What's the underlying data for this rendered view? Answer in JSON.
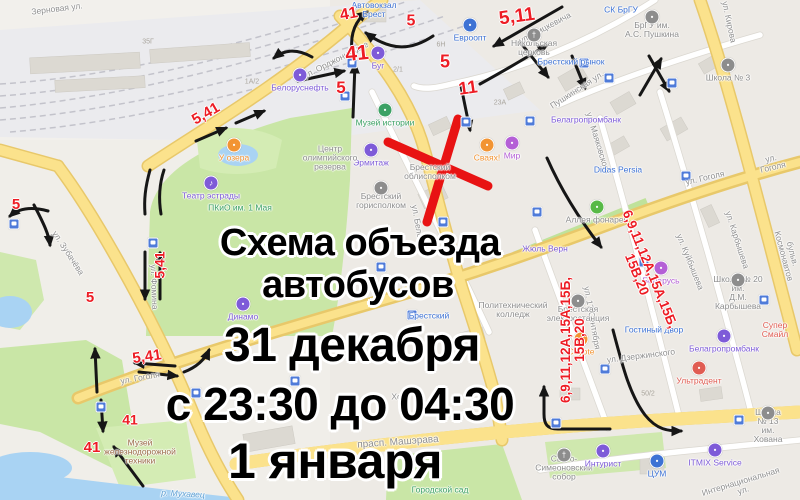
{
  "page": {
    "width": 800,
    "height": 500
  },
  "overlay": {
    "lines": [
      {
        "text": "Схема объезда",
        "x": 360,
        "y": 222,
        "size": 38
      },
      {
        "text": "автобусов",
        "x": 358,
        "y": 264,
        "size": 38
      },
      {
        "text": "31 декабря",
        "x": 352,
        "y": 318,
        "size": 48
      },
      {
        "text": "с 23:30 до 04:30",
        "x": 340,
        "y": 377,
        "size": 46
      },
      {
        "text": "1 января",
        "x": 335,
        "y": 432,
        "size": 50
      }
    ]
  },
  "route_labels": [
    {
      "text": "41",
      "x": 349,
      "y": 15,
      "size": 16,
      "rot": -10
    },
    {
      "text": "5",
      "x": 411,
      "y": 22,
      "size": 16,
      "rot": 0
    },
    {
      "text": "5,11",
      "x": 517,
      "y": 17,
      "size": 19,
      "rot": -8
    },
    {
      "text": "41",
      "x": 357,
      "y": 54,
      "size": 21,
      "rot": -6
    },
    {
      "text": "5",
      "x": 445,
      "y": 62,
      "size": 18,
      "rot": 0
    },
    {
      "text": "11",
      "x": 468,
      "y": 88,
      "size": 18,
      "rot": -8
    },
    {
      "text": "5",
      "x": 341,
      "y": 88,
      "size": 17,
      "rot": 0
    },
    {
      "text": "5,41",
      "x": 206,
      "y": 114,
      "size": 15,
      "rot": -30
    },
    {
      "text": "5",
      "x": 16,
      "y": 205,
      "size": 15,
      "rot": 0
    },
    {
      "text": "5",
      "x": 90,
      "y": 298,
      "size": 15,
      "rot": 0
    },
    {
      "text": "5,41",
      "x": 160,
      "y": 265,
      "size": 14,
      "rot": -90
    },
    {
      "text": "5,41",
      "x": 147,
      "y": 357,
      "size": 15,
      "rot": -8
    },
    {
      "text": "41",
      "x": 130,
      "y": 420,
      "size": 14,
      "rot": 0
    },
    {
      "text": "41",
      "x": 92,
      "y": 448,
      "size": 15,
      "rot": 0
    }
  ],
  "multi_route_labels": [
    {
      "text": "6,9,11,12А,15А,15Б,\n15В,20",
      "x": 643,
      "y": 272,
      "size": 13.5,
      "rot": 68
    },
    {
      "text": "6,9,11,12А,15А,15Б,\n15В,20",
      "x": 573,
      "y": 340,
      "size": 13.5,
      "rot": -90
    }
  ],
  "streets": [
    {
      "text": "Зерновая ул.",
      "x": 57,
      "y": 9,
      "rot": -7
    },
    {
      "text": "ул. Орджоникидзе",
      "x": 336,
      "y": 60,
      "rot": -27
    },
    {
      "text": "ул. Мицкевича",
      "x": 545,
      "y": 28,
      "rot": -28
    },
    {
      "text": "ул. Кирова",
      "x": 729,
      "y": 22,
      "rot": 78
    },
    {
      "text": "Пушкинская ул.",
      "x": 577,
      "y": 90,
      "rot": -33
    },
    {
      "text": "ул. Маяковского",
      "x": 598,
      "y": 143,
      "rot": 73
    },
    {
      "text": "ул. Куйбышева",
      "x": 690,
      "y": 262,
      "rot": 68
    },
    {
      "text": "ул. Карбышева",
      "x": 737,
      "y": 240,
      "rot": 72
    },
    {
      "text": "ул. Гоголя",
      "x": 705,
      "y": 178,
      "rot": -13
    },
    {
      "text": "ул. Гоголя",
      "x": 772,
      "y": 163,
      "rot": -13
    },
    {
      "text": "бульв. Космонавтов",
      "x": 788,
      "y": 255,
      "rot": 75
    },
    {
      "text": "ул. Зубачёва",
      "x": 68,
      "y": 253,
      "rot": 57
    },
    {
      "text": "ул. Фомина",
      "x": 154,
      "y": 287,
      "rot": 88
    },
    {
      "text": "ул. Гоголя",
      "x": 140,
      "y": 378,
      "rot": -10
    },
    {
      "text": "прасп. Машэрава",
      "x": 398,
      "y": 443,
      "rot": -4,
      "size": 10
    },
    {
      "text": "ул. Дзержинского",
      "x": 641,
      "y": 356,
      "rot": -7
    },
    {
      "text": "Интернациональная ул.",
      "x": 742,
      "y": 486,
      "rot": -17
    },
    {
      "text": "ул. 17 Сентября",
      "x": 592,
      "y": 318,
      "rot": 80
    },
    {
      "text": "ул. Белова",
      "x": 418,
      "y": 226,
      "rot": 80
    },
    {
      "text": "р. Мухавец",
      "x": 183,
      "y": 494,
      "rot": 3,
      "color": "#5d9fd3",
      "italic": true
    }
  ],
  "pois": [
    {
      "text": "Автовокзал\nБрест",
      "x": 374,
      "y": 10,
      "color": "blue"
    },
    {
      "text": "Белоруснефть",
      "x": 300,
      "y": 88,
      "color": "purple",
      "icon": true
    },
    {
      "text": "Буг",
      "x": 378,
      "y": 66,
      "color": "purple",
      "icon": true
    },
    {
      "text": "Евроопт",
      "x": 470,
      "y": 38,
      "color": "blue",
      "icon": true
    },
    {
      "text": "Никольская\nцерковь",
      "x": 534,
      "y": 48,
      "color": "gray",
      "icon": true,
      "glyph": "†"
    },
    {
      "text": "СК БрГУ",
      "x": 621,
      "y": 10,
      "color": "blue"
    },
    {
      "text": "БрГУ им.\nА.С. Пушкина",
      "x": 652,
      "y": 30,
      "color": "gray",
      "icon": true
    },
    {
      "text": "Брестский рынок",
      "x": 571,
      "y": 62,
      "color": "blue"
    },
    {
      "text": "Белагропромбанк",
      "x": 586,
      "y": 120,
      "color": "purple"
    },
    {
      "text": "Школа № 3",
      "x": 728,
      "y": 78,
      "color": "gray",
      "icon": true
    },
    {
      "text": "Школа № 20 им.\nД.М. Карбышева",
      "x": 738,
      "y": 293,
      "color": "gray",
      "icon": true
    },
    {
      "text": "Школа № 13\nим. Хована",
      "x": 768,
      "y": 426,
      "color": "gray",
      "icon": true
    },
    {
      "text": "Didas Persia",
      "x": 618,
      "y": 170,
      "color": "blue"
    },
    {
      "text": "Аллея фонарей",
      "x": 597,
      "y": 220,
      "color": "gray",
      "icon": true,
      "iconColor": "#58b947"
    },
    {
      "text": "Музей истории",
      "x": 385,
      "y": 123,
      "color": "green",
      "icon": true
    },
    {
      "text": "Эрмитаж",
      "x": 371,
      "y": 163,
      "color": "purple",
      "icon": true
    },
    {
      "text": "Центр\nолимпийского\nрезерва",
      "x": 330,
      "y": 158,
      "color": "gray"
    },
    {
      "text": "Театр эстрады",
      "x": 211,
      "y": 196,
      "color": "purple",
      "icon": true,
      "glyph": "♪"
    },
    {
      "text": "ПКиО им. 1 Мая",
      "x": 240,
      "y": 208,
      "color": "green"
    },
    {
      "text": "У озера",
      "x": 234,
      "y": 158,
      "color": "orange",
      "icon": true
    },
    {
      "text": "Динамо",
      "x": 243,
      "y": 317,
      "color": "purple",
      "icon": true
    },
    {
      "text": "Музей\nжелезнодорожной\nтехники",
      "x": 140,
      "y": 452,
      "color": "brown"
    },
    {
      "text": "Брестский\nоблисполком",
      "x": 430,
      "y": 172,
      "color": "gray"
    },
    {
      "text": "Брестский\nгорисполком",
      "x": 381,
      "y": 201,
      "color": "gray",
      "icon": true
    },
    {
      "text": "Мир",
      "x": 512,
      "y": 156,
      "color": "pink",
      "icon": true
    },
    {
      "text": "Сваях!",
      "x": 487,
      "y": 158,
      "color": "orange",
      "icon": true
    },
    {
      "text": "Гостиный двор",
      "x": 654,
      "y": 330,
      "color": "blue"
    },
    {
      "text": "Белагропромбанк",
      "x": 724,
      "y": 349,
      "color": "purple",
      "icon": true
    },
    {
      "text": "Ультрадент",
      "x": 699,
      "y": 381,
      "color": "red",
      "icon": true
    },
    {
      "text": "Супер Смайл",
      "x": 775,
      "y": 330,
      "color": "red"
    },
    {
      "text": "Coyote",
      "x": 581,
      "y": 352,
      "color": "orange",
      "icon": true
    },
    {
      "text": "Свято-\nСимеоновский\nсобор",
      "x": 564,
      "y": 468,
      "color": "gray",
      "icon": true,
      "glyph": "†"
    },
    {
      "text": "Интурист",
      "x": 603,
      "y": 464,
      "color": "purple",
      "icon": true
    },
    {
      "text": "ЦУМ",
      "x": 657,
      "y": 474,
      "color": "blue",
      "icon": true
    },
    {
      "text": "ITMIX Service",
      "x": 715,
      "y": 463,
      "color": "purple",
      "icon": true
    },
    {
      "text": "Городской сад",
      "x": 440,
      "y": 490,
      "color": "green"
    },
    {
      "text": "Беларусь",
      "x": 661,
      "y": 281,
      "color": "pink",
      "icon": true
    },
    {
      "text": "Политехнический\nколледж",
      "x": 513,
      "y": 310,
      "color": "gray"
    },
    {
      "text": "Брестский",
      "x": 429,
      "y": 316,
      "color": "blue"
    },
    {
      "text": "Брестская\nэлектростанция",
      "x": 578,
      "y": 314,
      "color": "gray",
      "icon": true
    },
    {
      "text": "Жюль Верн",
      "x": 545,
      "y": 249,
      "color": "purple"
    },
    {
      "text": "Хору",
      "x": 401,
      "y": 397,
      "color": "gray"
    }
  ],
  "minor_labels": [
    {
      "text": "35Г",
      "x": 148,
      "y": 42
    },
    {
      "text": "1А/2",
      "x": 252,
      "y": 82
    },
    {
      "text": "6Н",
      "x": 441,
      "y": 45
    },
    {
      "text": "2/1",
      "x": 398,
      "y": 70
    },
    {
      "text": "23А",
      "x": 500,
      "y": 103
    },
    {
      "text": "50/2",
      "x": 648,
      "y": 394
    }
  ],
  "bus_stops": [
    [
      14,
      224
    ],
    [
      101,
      407
    ],
    [
      153,
      243
    ],
    [
      196,
      393
    ],
    [
      295,
      381
    ],
    [
      345,
      96
    ],
    [
      352,
      63
    ],
    [
      381,
      267
    ],
    [
      412,
      315
    ],
    [
      443,
      222
    ],
    [
      466,
      122
    ],
    [
      530,
      121
    ],
    [
      537,
      212
    ],
    [
      556,
      423
    ],
    [
      605,
      369
    ],
    [
      644,
      262
    ],
    [
      672,
      83
    ],
    [
      686,
      176
    ],
    [
      739,
      420
    ],
    [
      764,
      300
    ],
    [
      609,
      78
    ],
    [
      584,
      63
    ]
  ],
  "colors": {
    "route_red": "#ed1c24",
    "closure_red": "#e81313",
    "arrow_black": "#161616",
    "blue": "#3d72d4",
    "purple": "#7e5bd8",
    "pink": "#b45fd6",
    "green": "#3ba164",
    "orange": "#f29433",
    "red": "#e05c52",
    "gray": "#8d8d8d",
    "brown": "#9c6b4a",
    "road_yellow": "#fbe28c",
    "park_green": "#c9e6a6",
    "water_blue": "#a9d3f3"
  }
}
